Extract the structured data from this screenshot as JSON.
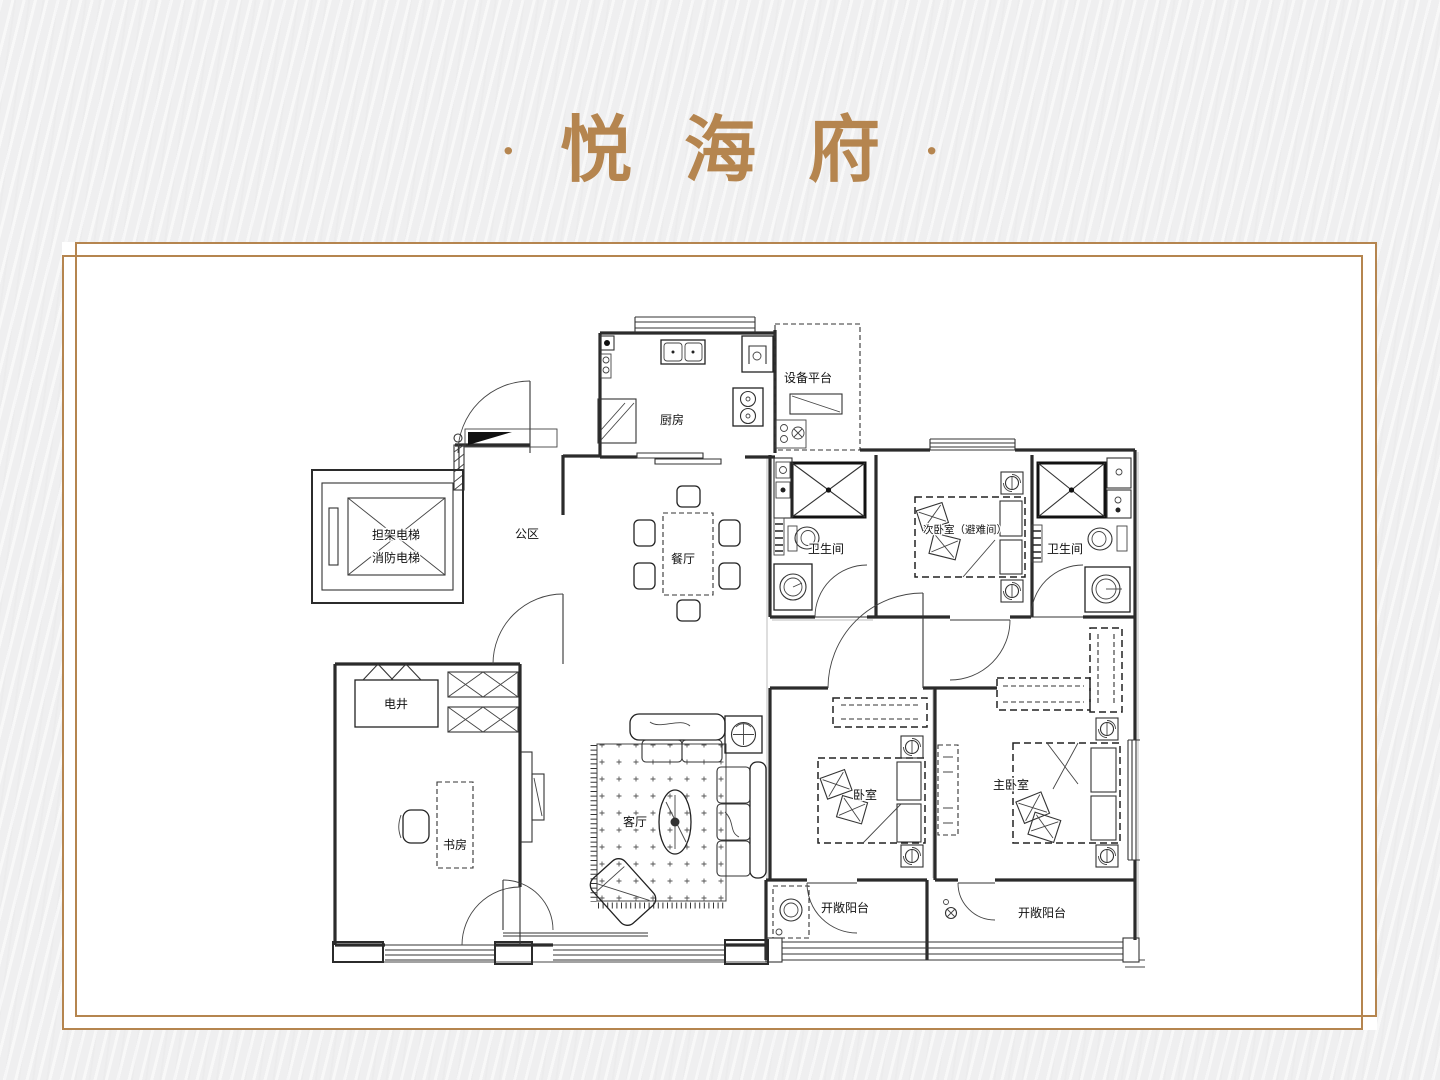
{
  "header": {
    "decor_dot": "·",
    "title": "悦海府"
  },
  "floor_plan": {
    "rooms": {
      "equipment_platform": "设备平台",
      "kitchen": "厨房",
      "public_area": "公区",
      "elevator_line1": "担架电梯",
      "elevator_line2": "消防电梯",
      "dining": "餐厅",
      "bath1": "卫生间",
      "bedroom2": "次卧室（避难间）",
      "bath2": "卫生间",
      "shaft": "电井",
      "study": "书房",
      "living": "客厅",
      "bedroom1": "卧室",
      "master": "主卧室",
      "balcony1": "开敞阳台",
      "balcony2": "开敞阳台"
    },
    "colors": {
      "accent": "#b5854f",
      "line": "#2b2b2b",
      "panel": "#ffffff",
      "background": "#efeff0"
    }
  }
}
